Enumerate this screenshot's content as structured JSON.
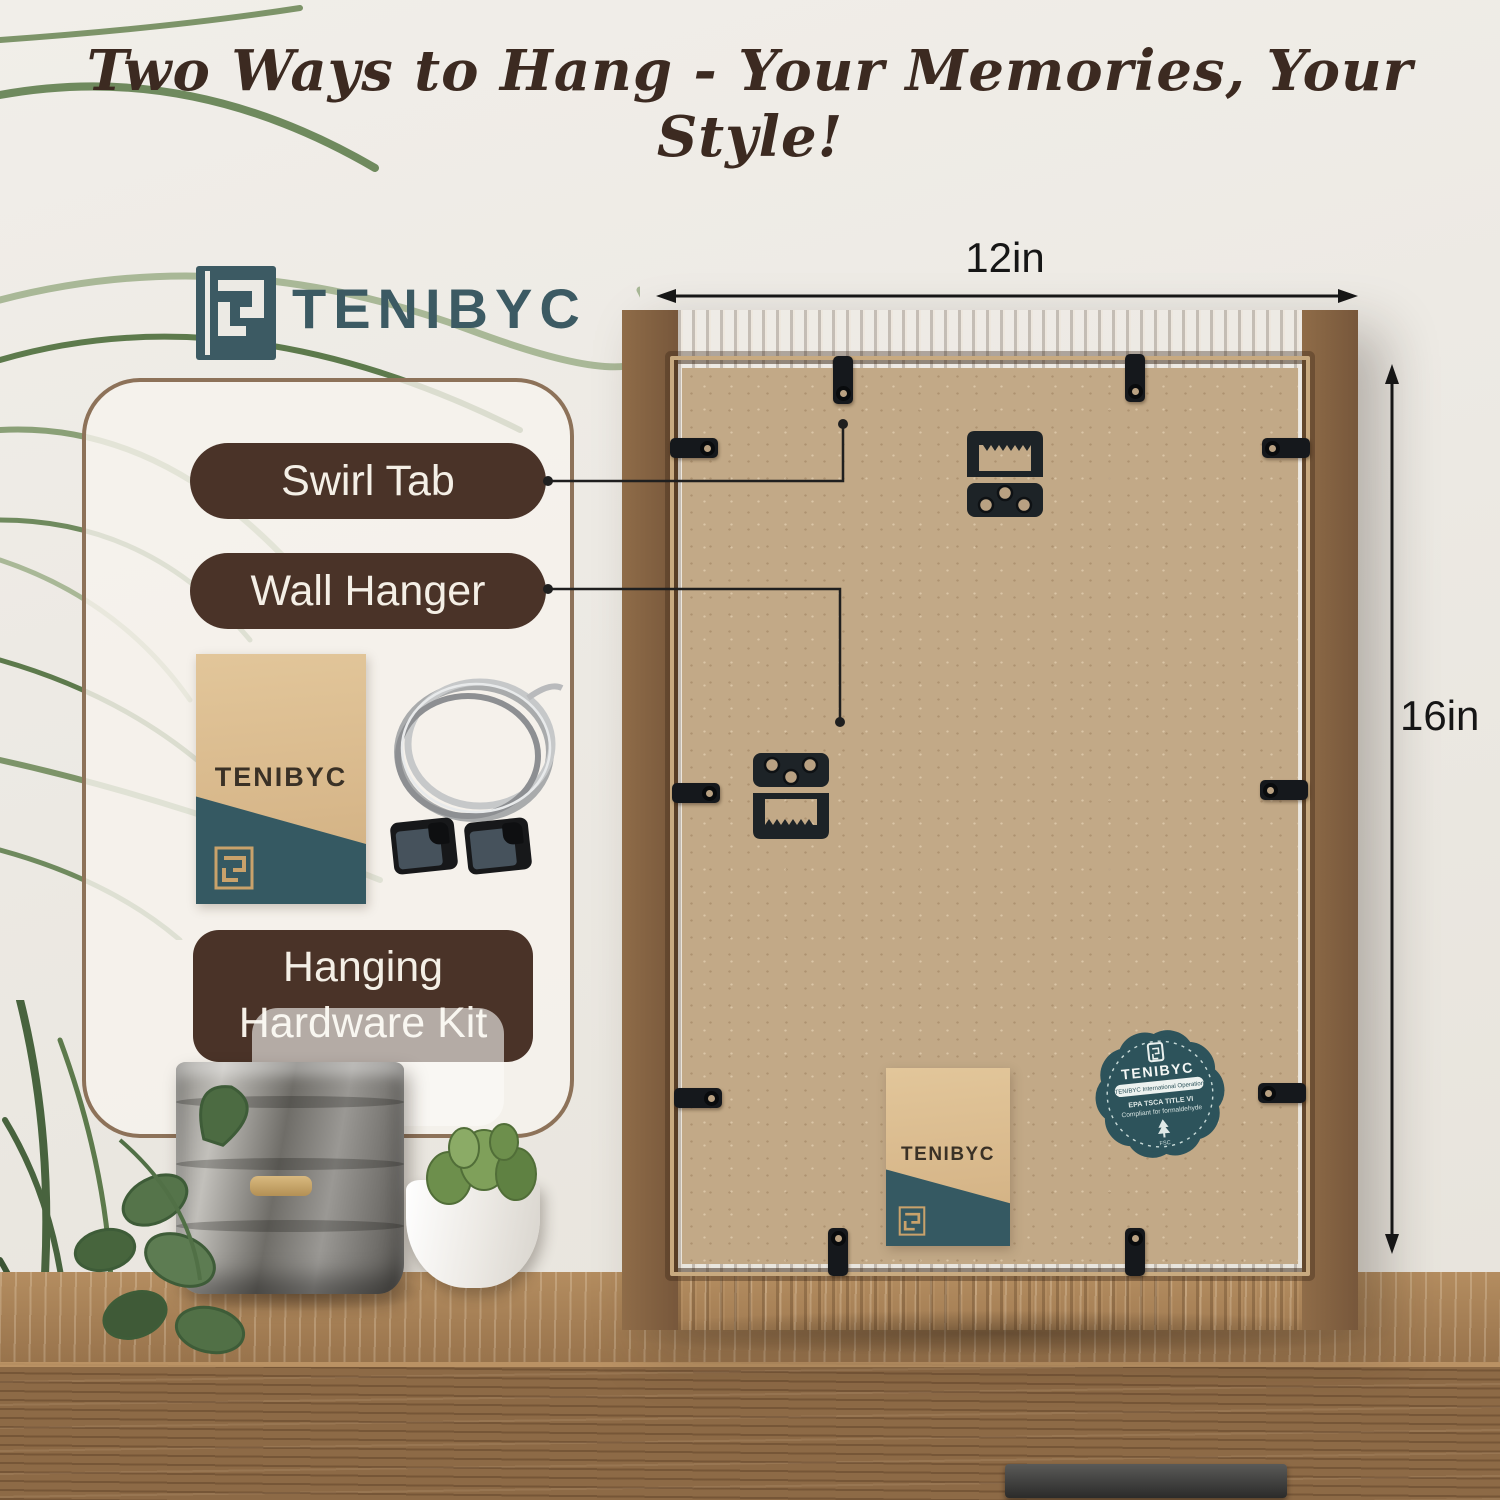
{
  "title": "Two Ways to Hang - Your Memories, Your Style!",
  "brand": {
    "wordmark": "TENIBYC"
  },
  "card": {
    "swirl_tab_label": "Swirl Tab",
    "wall_hanger_label": "Wall Hanger",
    "hardware_kit_label": "Hanging Hardware Kit",
    "kit_envelope_brand": "TENIBYC"
  },
  "frame": {
    "width_label": "12in",
    "height_label": "16in",
    "envelope_brand": "TENIBYC",
    "badge": {
      "brand": "TENIBYC",
      "subtitle_pill": "TENIBYC International Operation",
      "line1": "EPA TSCA TITLE VI",
      "line2": "Compliant for formaldehyde",
      "cert": "FSC"
    }
  },
  "colors": {
    "brand_teal": "#3c5a63",
    "badge_teal": "#2d535b",
    "pill_brown": "#4a3328",
    "title_brown": "#3c2a21",
    "frame_wood": "#8a6746",
    "board_tan": "#c2a987"
  }
}
